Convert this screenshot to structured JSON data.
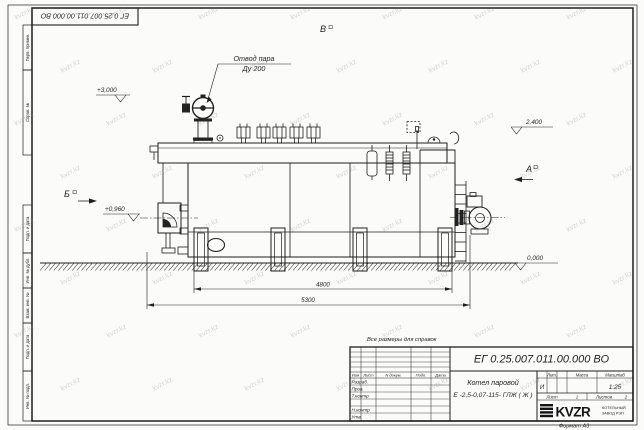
{
  "watermark": {
    "text": "kvzr.kz"
  },
  "frame": {
    "top_stamp": "ЕГ 0.25.007.011.00.000  ВО",
    "margin_labels": [
      "Перв. примен.",
      "Справ. №",
      "Подп. и дата",
      "Инв. № дубл.",
      "Взам. инв. №",
      "Подп. и дата",
      "Инв. № подл."
    ],
    "format_note": "Формат А3"
  },
  "note": "Все размеры для справок",
  "drawing": {
    "callout": {
      "line1": "Отвод пара",
      "line2": "Ду 200"
    },
    "view_labels": {
      "top": "В",
      "left": "Б",
      "right": "А"
    },
    "elevations": {
      "valve_top": "+3,000",
      "drum_top": "2,400",
      "burner_axis": "+0,960",
      "ground": "0,000"
    },
    "dimensions": {
      "inner": "4800",
      "overall": "5300"
    }
  },
  "title_block": {
    "doc_number": "ЕГ 0.25.007.011.00.000  ВО",
    "product_name_line1": "Котел паровой",
    "product_name_line2": "Е -2,5-0,07-115- ГЛЖ ( Ж )",
    "header_cols": {
      "izm": "Изм",
      "list": "Лист",
      "ndoc": "N докум.",
      "podp": "Подп.",
      "data": "Дата"
    },
    "staff_rows": {
      "r1": "Разраб.",
      "r2": "Пров.",
      "r3": "Т.контр",
      "r5": "Н.контр",
      "r6": "Утв."
    },
    "lit": {
      "header": "Лит.",
      "value": "И"
    },
    "mass": {
      "header": "Масса"
    },
    "scale": {
      "header": "Масштаб",
      "value": "1:25"
    },
    "sheet": {
      "label": "Лист",
      "value": "1"
    },
    "sheets": {
      "label": "Листов",
      "value": "2"
    },
    "logo": {
      "text": "KVZR",
      "caption1": "КОТЕЛЬНЫЙ",
      "caption2": "ЗАВОД РЭП"
    }
  }
}
